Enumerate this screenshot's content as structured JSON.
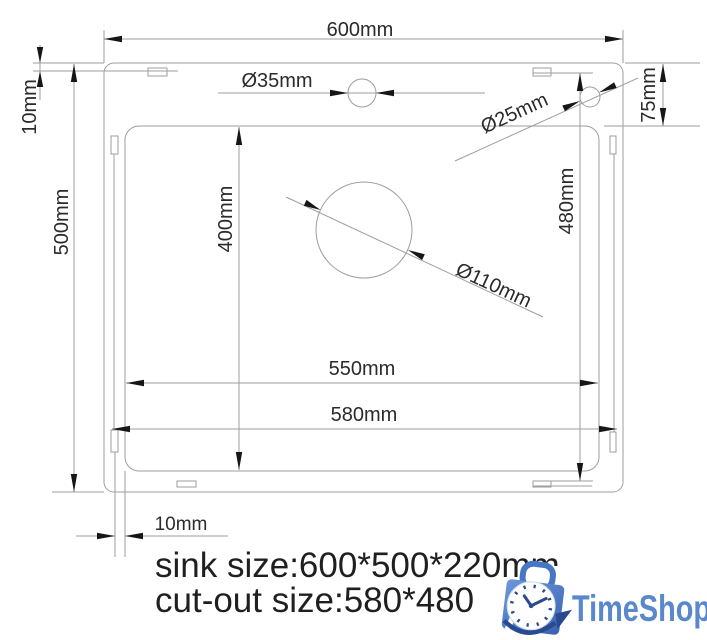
{
  "colors": {
    "drawing_line": "#9e9e9e",
    "dimension_text": "#2b2b2b",
    "arrow": "#161616",
    "logo_text_blue": "#5b87cd",
    "bag_blue_light": "#6a98da",
    "bag_blue_dark": "#3a62b0",
    "clock_detail_blue": "#2a4a8f"
  },
  "labels": {
    "width_600": "600mm",
    "flange_top_10": "10mm",
    "height_500": "500mm",
    "faucet_hole_35": "Ø35mm",
    "accessory_hole_25": "Ø25mm",
    "offset_75": "75mm",
    "bowl_depth_400": "400mm",
    "cutout_height_480": "480mm",
    "drain_hole_110": "Ø110mm",
    "bowl_width_550": "550mm",
    "cutout_width_580": "580mm",
    "flange_bottom_10": "10mm"
  },
  "notes": {
    "sink_size": "sink size:600*500*220mm",
    "cutout_size": "cut-out size:580*480"
  },
  "logo": {
    "brand": "TimeShop"
  }
}
